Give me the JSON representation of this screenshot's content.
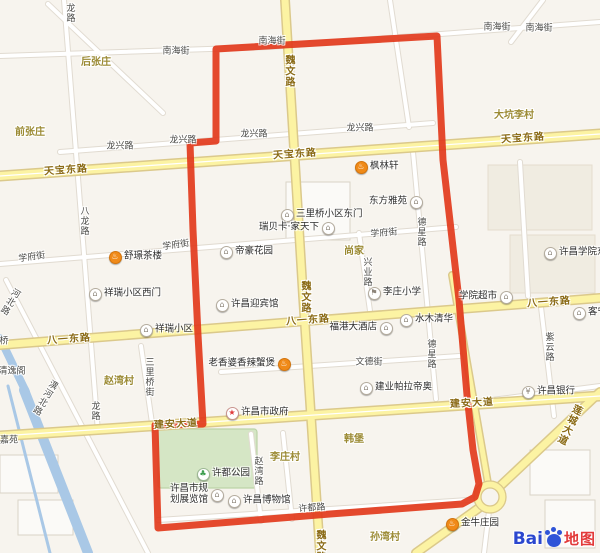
{
  "palette": {
    "background": "#f7f4ee",
    "boundary": "#e2391c",
    "yellow_road_fill": "#fcf3a3",
    "yellow_road_edge": "#dbc98b",
    "white_road_fill": "#ffffff",
    "white_road_edge": "#e1dbd1",
    "river": "#a9c8e6",
    "park_fill": "#d5e6c5",
    "park_edge": "#bcd3a8",
    "street_text": "#4b4b48",
    "road_text": "#8a6a15",
    "village_text": "#9b8a33",
    "poi_text": "#2e2e2e"
  },
  "boundary": {
    "color": "#e2391c",
    "width": 7,
    "path": "M216,141 L216,49 L437,36 L443,160 L451,230 L459,300 L467,395 L473,450 L479,484 L475,497 L462,504 L330,514 L158,528 L155,425 L203,424 L198,335 L193,230 L190,143 Z"
  },
  "geometry": {
    "blocks": [
      [
        488,
        165,
        104,
        65,
        "#f0ece1",
        "#e4ddcd"
      ],
      [
        510,
        235,
        85,
        58,
        "#f0ece1",
        "#e4ddcd"
      ],
      [
        286,
        182,
        64,
        58,
        "#fbfaf7",
        "#d9d3c7"
      ],
      [
        530,
        450,
        60,
        45,
        "#fbfaf7",
        "#d9d3c7"
      ],
      [
        545,
        500,
        50,
        48,
        "#fbfaf7",
        "#d9d3c7"
      ],
      [
        0,
        455,
        58,
        38,
        "#fbfaf7",
        "#d9d3c7"
      ],
      [
        18,
        500,
        55,
        35,
        "#fbfaf7",
        "#d9d3c7"
      ]
    ],
    "park": [
      158,
      429,
      99,
      59
    ],
    "rivers": [
      [
        0,
        338,
        26,
        392,
        8
      ],
      [
        24,
        390,
        88,
        553,
        10
      ],
      [
        8,
        386,
        50,
        553,
        3
      ]
    ],
    "white_roads": [
      [
        0,
        56,
        268,
        47
      ],
      [
        268,
        47,
        600,
        22
      ],
      [
        543,
        0,
        511,
        42
      ],
      [
        48,
        4,
        163,
        113
      ],
      [
        390,
        0,
        409,
        127
      ],
      [
        60,
        152,
        433,
        123
      ],
      [
        0,
        264,
        456,
        227
      ],
      [
        221,
        372,
        459,
        356
      ],
      [
        64,
        0,
        98,
        432
      ],
      [
        141,
        346,
        153,
        430
      ],
      [
        413,
        152,
        436,
        399
      ],
      [
        359,
        233,
        371,
        318
      ],
      [
        541,
        307,
        554,
        416
      ],
      [
        251,
        434,
        261,
        521
      ],
      [
        6,
        280,
        148,
        553
      ],
      [
        158,
        520,
        484,
        499
      ],
      [
        468,
        403,
        600,
        386
      ],
      [
        283,
        433,
        292,
        519
      ],
      [
        489,
        511,
        484,
        553
      ],
      [
        520,
        162,
        528,
        296
      ]
    ],
    "yellow_roads": [
      [
        285,
        0,
        303,
        295,
        10
      ],
      [
        303,
        295,
        320,
        553,
        10
      ],
      [
        0,
        176,
        600,
        134,
        11
      ],
      [
        0,
        345,
        600,
        298,
        10
      ],
      [
        0,
        436,
        600,
        396,
        11
      ],
      [
        600,
        392,
        497,
        489,
        10
      ],
      [
        483,
        505,
        416,
        553,
        10
      ],
      [
        452,
        275,
        489,
        489,
        8
      ]
    ],
    "centerlines": [
      [
        0,
        176,
        600,
        134
      ],
      [
        0,
        436,
        600,
        396
      ]
    ],
    "roundabout": {
      "x": 490,
      "y": 497,
      "outer_r": 16,
      "inner_r": 9
    }
  },
  "labels": [
    {
      "text": "南海街",
      "x": 176,
      "y": 52,
      "type": "street"
    },
    {
      "text": "南海街",
      "x": 272,
      "y": 42,
      "type": "street"
    },
    {
      "text": "南海街",
      "x": 497,
      "y": 28,
      "type": "street"
    },
    {
      "text": "南海街",
      "x": 539,
      "y": 29,
      "type": "street"
    },
    {
      "text": "龙兴路",
      "x": 120,
      "y": 147,
      "type": "street"
    },
    {
      "text": "龙兴路",
      "x": 183,
      "y": 141,
      "type": "street"
    },
    {
      "text": "龙兴路",
      "x": 254,
      "y": 135,
      "type": "street"
    },
    {
      "text": "龙兴路",
      "x": 360,
      "y": 129,
      "type": "street"
    },
    {
      "text": "学府街",
      "x": 32,
      "y": 258,
      "type": "street",
      "rot": -8
    },
    {
      "text": "学府街",
      "x": 176,
      "y": 246,
      "type": "street",
      "rot": -8
    },
    {
      "text": "学府街",
      "x": 384,
      "y": 234,
      "type": "street",
      "rot": -5
    },
    {
      "text": "文德街",
      "x": 369,
      "y": 363,
      "type": "street"
    },
    {
      "text": "许都路",
      "x": 312,
      "y": 509,
      "type": "street",
      "rot": -4
    },
    {
      "text": "龙路",
      "x": 69,
      "y": 13,
      "type": "street",
      "vertical": true
    },
    {
      "text": "八龙路",
      "x": 83,
      "y": 221,
      "type": "street",
      "vertical": true
    },
    {
      "text": "龙路",
      "x": 94,
      "y": 411,
      "type": "street",
      "vertical": true
    },
    {
      "text": "三里桥街",
      "x": 148,
      "y": 377,
      "type": "street",
      "vertical": true
    },
    {
      "text": "德星路",
      "x": 420,
      "y": 232,
      "type": "street",
      "vertical": true
    },
    {
      "text": "德星路",
      "x": 430,
      "y": 354,
      "type": "street",
      "vertical": true
    },
    {
      "text": "兴业路",
      "x": 366,
      "y": 272,
      "type": "street",
      "vertical": true
    },
    {
      "text": "紫云路",
      "x": 548,
      "y": 347,
      "type": "street",
      "vertical": true
    },
    {
      "text": "赵湾路",
      "x": 257,
      "y": 471,
      "type": "street",
      "vertical": true
    },
    {
      "text": "潩河北路",
      "x": 44,
      "y": 397,
      "type": "street",
      "vertical": true,
      "rot": 31
    },
    {
      "text": "河北路",
      "x": 9,
      "y": 301,
      "type": "street",
      "vertical": true,
      "rot": 31
    },
    {
      "text": "桥",
      "x": 4,
      "y": 342,
      "type": "street"
    },
    {
      "text": "清逸阁",
      "x": 12,
      "y": 372,
      "type": "street"
    },
    {
      "text": "嘉苑",
      "x": 9,
      "y": 441,
      "type": "street"
    },
    {
      "text": "魏文路",
      "x": 288,
      "y": 71,
      "type": "road",
      "vertical": true
    },
    {
      "text": "魏文路",
      "x": 304,
      "y": 297,
      "type": "road",
      "vertical": true
    },
    {
      "text": "魏文路",
      "x": 319,
      "y": 546,
      "type": "road",
      "vertical": true
    },
    {
      "text": "天宝东路",
      "x": 66,
      "y": 171,
      "type": "road",
      "rot": -4
    },
    {
      "text": "天宝东路",
      "x": 295,
      "y": 155,
      "type": "road",
      "rot": -4
    },
    {
      "text": "天宝东路",
      "x": 523,
      "y": 139,
      "type": "road",
      "rot": -4
    },
    {
      "text": "八一东路",
      "x": 69,
      "y": 340,
      "type": "road",
      "rot": -4
    },
    {
      "text": "八一东路",
      "x": 308,
      "y": 321,
      "type": "road",
      "rot": -4
    },
    {
      "text": "八一东路",
      "x": 549,
      "y": 303,
      "type": "road",
      "rot": -4
    },
    {
      "text": "建安大道",
      "x": 176,
      "y": 425,
      "type": "road",
      "rot": -3
    },
    {
      "text": "建安大道",
      "x": 472,
      "y": 404,
      "type": "road",
      "rot": -3
    },
    {
      "text": "莲城大道",
      "x": 568,
      "y": 424,
      "type": "road",
      "vertical": true,
      "rot": 26
    },
    {
      "text": "后张庄",
      "x": 96,
      "y": 63,
      "type": "village"
    },
    {
      "text": "前张庄",
      "x": 30,
      "y": 133,
      "type": "village"
    },
    {
      "text": "大坑李村",
      "x": 514,
      "y": 116,
      "type": "village"
    },
    {
      "text": "尚家",
      "x": 354,
      "y": 252,
      "type": "village"
    },
    {
      "text": "赵湾村",
      "x": 119,
      "y": 382,
      "type": "village"
    },
    {
      "text": "韩堡",
      "x": 354,
      "y": 440,
      "type": "village"
    },
    {
      "text": "李庄村",
      "x": 285,
      "y": 458,
      "type": "village"
    },
    {
      "text": "孙湾村",
      "x": 385,
      "y": 538,
      "type": "village"
    }
  ],
  "icons": {
    "food": {
      "glyph": "♨",
      "bg": "#f08a18",
      "border": "#d3750e",
      "fg": "#ffffff"
    },
    "building": {
      "glyph": "⌂",
      "bg": "#ffffff",
      "border": "#b4ac9e",
      "fg": "#8d857a"
    },
    "hotel": {
      "glyph": "⌂",
      "bg": "#ffffff",
      "border": "#b4ac9e",
      "fg": "#8d857a"
    },
    "school": {
      "glyph": "⚑",
      "bg": "#ffffff",
      "border": "#b4ac9e",
      "fg": "#8d857a"
    },
    "shop": {
      "glyph": "⌂",
      "bg": "#ffffff",
      "border": "#b4ac9e",
      "fg": "#8d857a"
    },
    "college": {
      "glyph": "⌂",
      "bg": "#ffffff",
      "border": "#b4ac9e",
      "fg": "#8d857a"
    },
    "bank": {
      "glyph": "¥",
      "bg": "#ffffff",
      "border": "#b4ac9e",
      "fg": "#8d857a"
    },
    "government": {
      "glyph": "★",
      "bg": "#ffffff",
      "border": "#c9948e",
      "fg": "#e03a3a"
    },
    "park": {
      "glyph": "♣",
      "bg": "#ffffff",
      "border": "#9cb893",
      "fg": "#3e9e4f"
    },
    "museum": {
      "glyph": "⌂",
      "bg": "#ffffff",
      "border": "#b4ac9e",
      "fg": "#8d857a"
    }
  },
  "pois": [
    {
      "label": "枫林轩",
      "x": 361,
      "y": 167,
      "icon": "food",
      "side": "east"
    },
    {
      "label": "东方雅苑",
      "x": 416,
      "y": 202,
      "icon": "building",
      "side": "west"
    },
    {
      "label": "三里桥小区东门",
      "x": 287,
      "y": 215,
      "icon": "building",
      "side": "east"
    },
    {
      "label": "瑞贝卡·家天下",
      "x": 328,
      "y": 228,
      "icon": "building",
      "side": "west"
    },
    {
      "label": "帝豪花园",
      "x": 226,
      "y": 252,
      "icon": "building",
      "side": "east"
    },
    {
      "label": "舒璟茶楼",
      "x": 115,
      "y": 257,
      "icon": "food",
      "side": "east"
    },
    {
      "label": "祥瑞小区西门",
      "x": 95,
      "y": 294,
      "icon": "building",
      "side": "east"
    },
    {
      "label": "祥瑞小区",
      "x": 146,
      "y": 330,
      "icon": "building",
      "side": "east"
    },
    {
      "label": "许昌迎宾馆",
      "x": 222,
      "y": 305,
      "icon": "hotel",
      "side": "east"
    },
    {
      "label": "李庄小学",
      "x": 374,
      "y": 293,
      "icon": "school",
      "side": "east"
    },
    {
      "label": "福港大酒店",
      "x": 386,
      "y": 328,
      "icon": "hotel",
      "side": "west"
    },
    {
      "label": "水木清华",
      "x": 406,
      "y": 320,
      "icon": "building",
      "side": "east"
    },
    {
      "label": "学院超市",
      "x": 506,
      "y": 297,
      "icon": "shop",
      "side": "west"
    },
    {
      "label": "许昌学院东村",
      "x": 550,
      "y": 253,
      "icon": "college",
      "side": "east"
    },
    {
      "label": "客宁",
      "x": 579,
      "y": 313,
      "icon": "shop",
      "side": "east"
    },
    {
      "label": "许昌银行",
      "x": 528,
      "y": 392,
      "icon": "bank",
      "side": "east"
    },
    {
      "label": "老香婆香辣蟹煲",
      "x": 284,
      "y": 364,
      "icon": "food",
      "side": "west"
    },
    {
      "label": "建业帕拉帝奥",
      "x": 366,
      "y": 388,
      "icon": "building",
      "side": "east"
    },
    {
      "label": "许昌市政府",
      "x": 232,
      "y": 413,
      "icon": "government",
      "side": "east"
    },
    {
      "label": "许都公园",
      "x": 203,
      "y": 474,
      "icon": "park",
      "side": "east"
    },
    {
      "label": "许昌市规划展览馆",
      "lines": [
        "许昌市规",
        "划展览馆"
      ],
      "x": 217,
      "y": 495,
      "icon": "museum",
      "side": "west"
    },
    {
      "label": "许昌博物馆",
      "x": 234,
      "y": 501,
      "icon": "museum",
      "side": "east"
    },
    {
      "label": "金牛庄园",
      "x": 452,
      "y": 524,
      "icon": "food",
      "side": "east"
    }
  ],
  "logo": {
    "bai": "Bai",
    "suffix": "地图"
  }
}
